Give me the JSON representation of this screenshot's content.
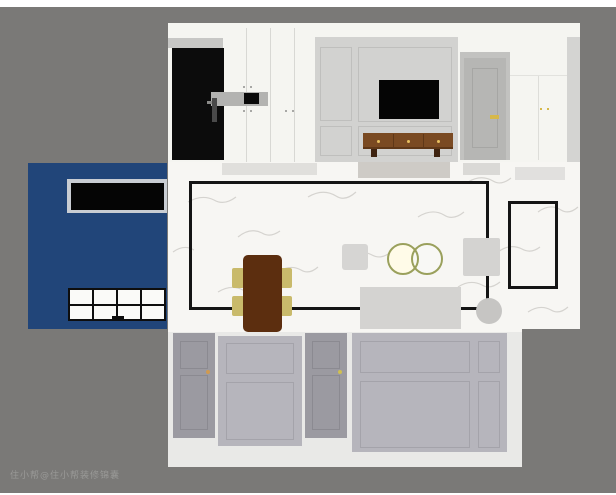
{
  "image": {
    "type": "top-down interior design floorplan render",
    "width_px": 616,
    "height_px": 495
  },
  "watermark": {
    "text": "住小帮@住小帮装修锦囊"
  },
  "palette": {
    "background_gray": "#7a7977",
    "wall_white": "#f5f5f1",
    "tv_panel_gray": "#d2d2d0",
    "accent_blue": "#214579",
    "outline_black": "#141414",
    "marble_floor": "#f7f6f3",
    "marble_vein": "#cdcbc7",
    "table_brown": "#5c2e0f",
    "console_brown": "#7a4a22",
    "chair_khaki": "#c9ba6b",
    "ring_olive": "#9aa05c",
    "hardware_gold": "#d6b84a",
    "dim_cabinet_gray": "#9b9aa1",
    "dim_panel_gray": "#b6b5bc",
    "sofa_gray": "#d4d3d1"
  },
  "scene": {
    "top_wall_elevation": {
      "elements": [
        "entry-door",
        "entry-cabinets",
        "display-shelf",
        "tv-panel-wall",
        "television",
        "tv-console",
        "interior-door",
        "wardrobe-cabinets"
      ]
    },
    "left_room": {
      "accent_color": "#214579",
      "elements": [
        "wall-television",
        "grid-window"
      ]
    },
    "living_dining_floor": {
      "elements": [
        "area-rug-outline",
        "dining-table",
        "dining-chairs",
        "side-table",
        "pendant-rings",
        "armchair",
        "sofa",
        "floor-lamp",
        "small-rug-outline",
        "door-mats"
      ]
    },
    "bottom_wall_elevation": {
      "dimmed": true,
      "elements": [
        "cabinet-door-left",
        "tall-cabinet-left",
        "cabinet-door-right",
        "tall-cabinet-right"
      ]
    }
  }
}
